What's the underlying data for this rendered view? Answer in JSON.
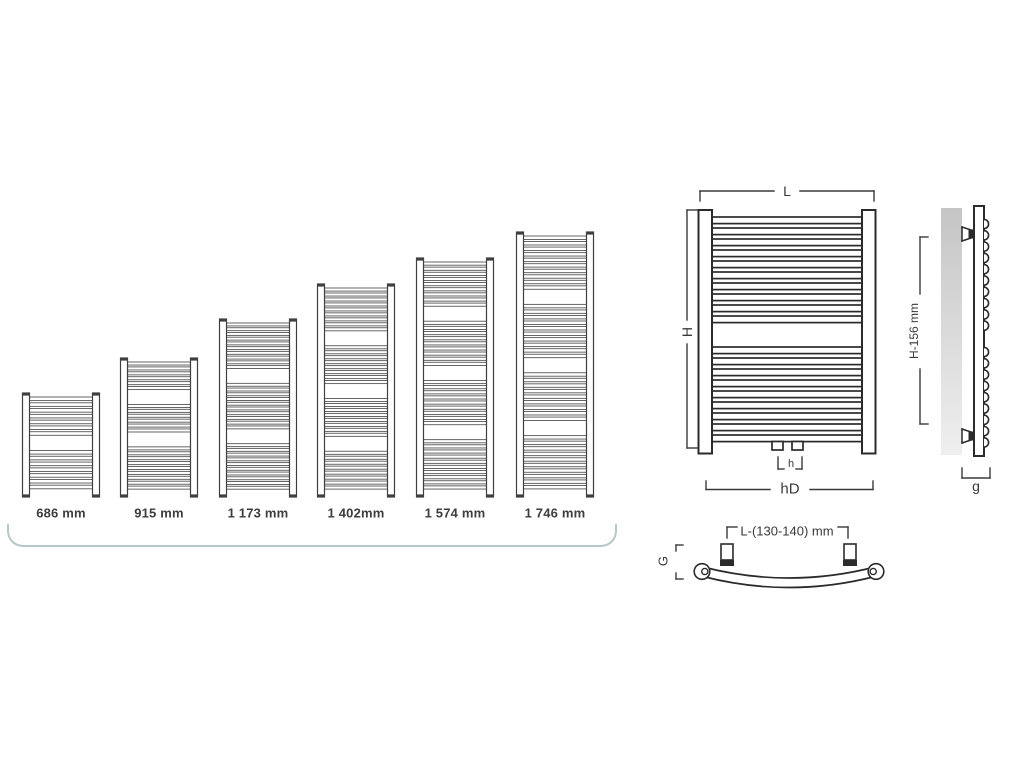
{
  "page": {
    "background": "#ffffff"
  },
  "lineup": {
    "sizes": [
      {
        "mm": 686,
        "label": "686 mm",
        "tube_groups": [
          7,
          7
        ]
      },
      {
        "mm": 915,
        "label": "915 mm",
        "tube_groups": [
          6,
          6,
          9
        ]
      },
      {
        "mm": 1173,
        "label": "1 173 mm",
        "tube_groups": [
          10,
          10,
          10
        ]
      },
      {
        "mm": 1402,
        "label": "1 402mm",
        "tube_groups": [
          9,
          8,
          8,
          8
        ]
      },
      {
        "mm": 1574,
        "label": "1 574 mm",
        "tube_groups": [
          9,
          9,
          9,
          10
        ]
      },
      {
        "mm": 1746,
        "label": "1 746 mm",
        "tube_groups": [
          10,
          10,
          9,
          10
        ]
      }
    ]
  },
  "front_view": {
    "width_dim": "L",
    "height_dim": "H",
    "valve_spacing_dim": "h",
    "connection_dim": "hD",
    "tube_groups": [
      10,
      9
    ]
  },
  "side_view": {
    "bracket_height_dim": "H-156 mm",
    "depth_dim": "g",
    "tube_bumps": [
      10,
      9
    ]
  },
  "top_view": {
    "bracket_spacing_dim": "L-(130-140) mm",
    "depth_dim": "G"
  },
  "colors": {
    "line": "#2b2b2b",
    "dim_line": "#3a3a3a",
    "mini_line": "#555555",
    "text": "#3a3a3a",
    "swoosh": "#b5c7ca",
    "wall_start": "#c5c5c5",
    "wall_end": "#efefef"
  }
}
